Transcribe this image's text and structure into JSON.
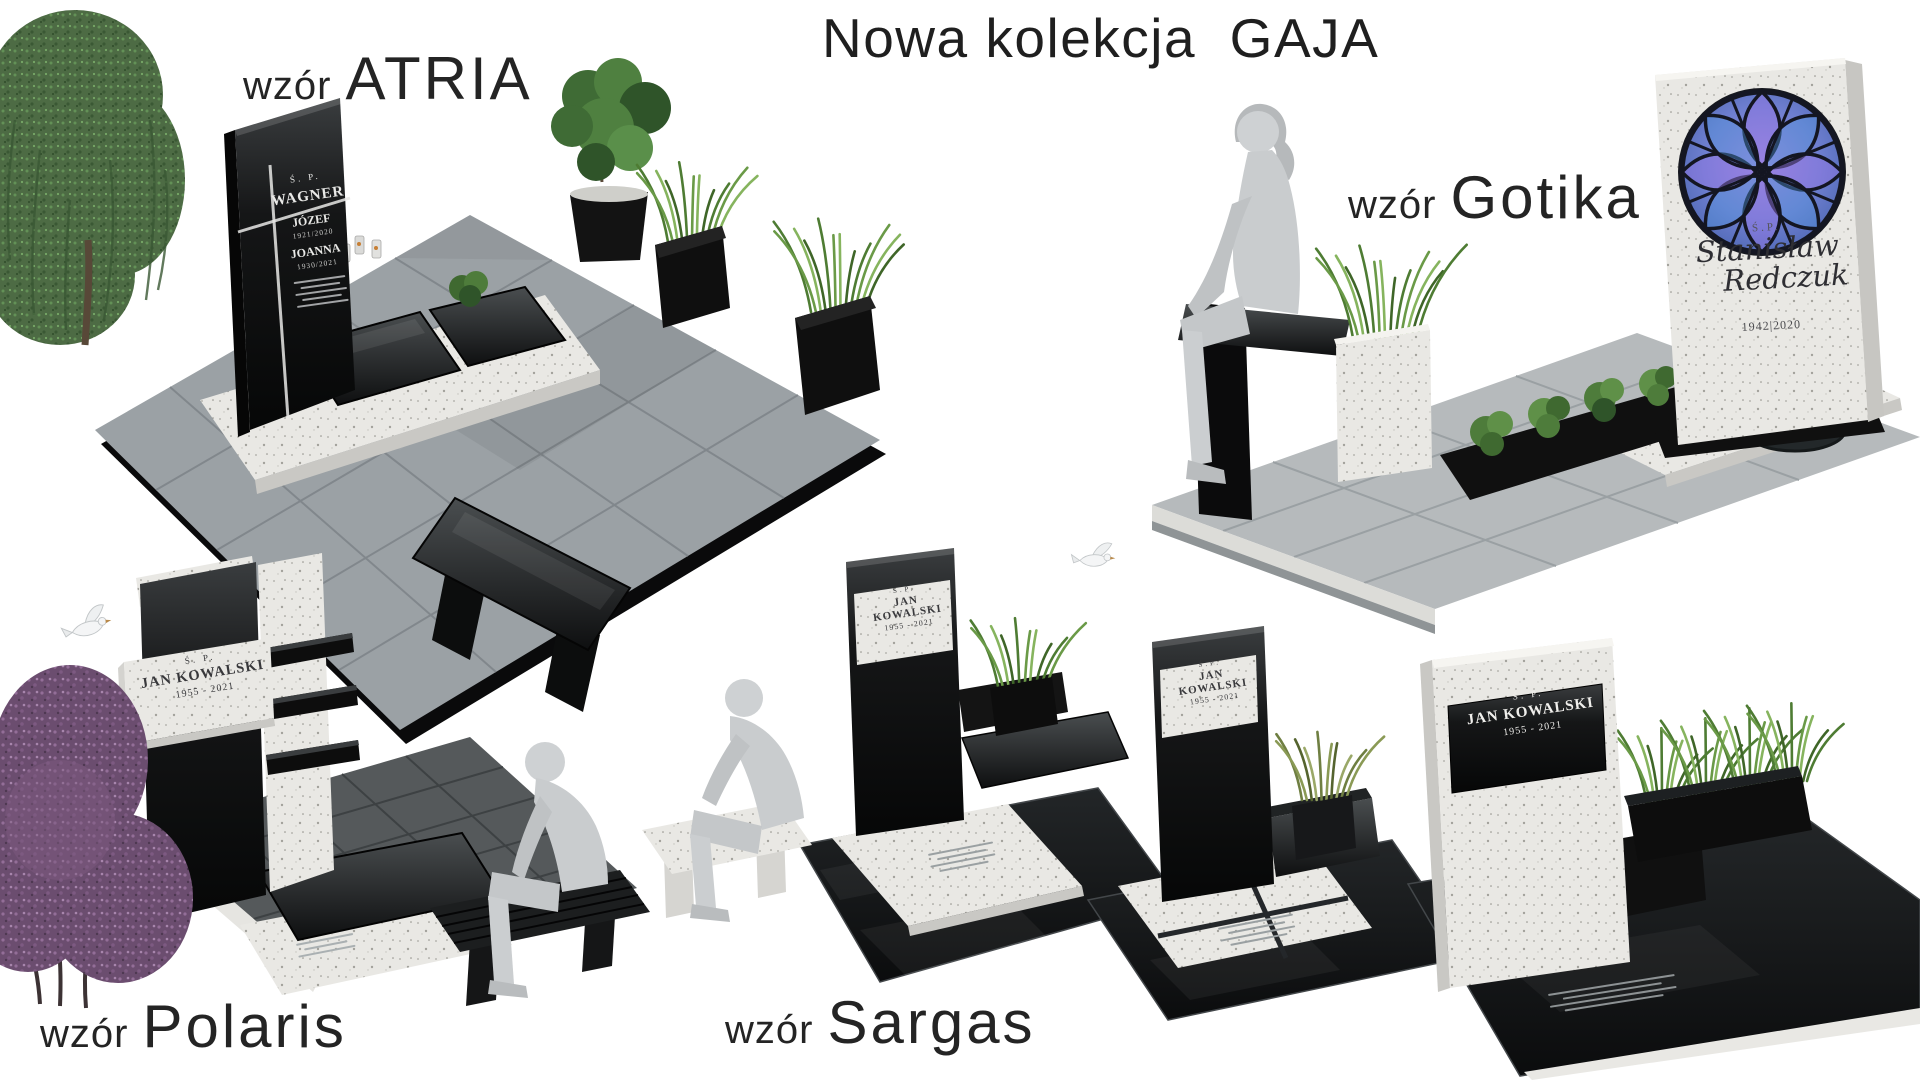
{
  "poster": {
    "title": "Nowa kolekcja  GAJA"
  },
  "labels": {
    "atria": {
      "prefix": "wzór",
      "name": "ATRIA"
    },
    "gotika": {
      "prefix": "wzór",
      "name": "Gotika"
    },
    "polaris": {
      "prefix": "wzór",
      "name": "Polaris"
    },
    "sargas": {
      "prefix": "wzór",
      "name": "Sargas"
    }
  },
  "inscriptions": {
    "atria": {
      "sp": "Ś. P.",
      "surname": "WAGNER",
      "name1": "JÓZEF",
      "dates1": "1921/2020",
      "name2": "JOANNA",
      "dates2": "1930/2021"
    },
    "gotika": {
      "sp": "Ś.P.",
      "name_line1": "Stanisław",
      "name_line2": "Redczuk",
      "dates": "1942|2020"
    },
    "polaris": {
      "sp": "Ś. P.",
      "name": "JAN KOWALSKI",
      "dates": "1955 - 2021"
    },
    "sargas_front": {
      "sp": "Ś.P.",
      "name": "JAN KOWALSKI",
      "dates": "1955 - 2021"
    },
    "sargas_side": {
      "sp": "Ś.P.",
      "name": "JAN KOWALSKI",
      "dates": "1955 - 2021"
    },
    "sargas_white": {
      "sp": "Ś. P.",
      "name": "JAN KOWALSKI",
      "dates": "1955 - 2021"
    }
  },
  "colors": {
    "granite_black": "#121314",
    "terrazzo_white": "#e9e8e4",
    "tile_gray": "#9ba1a5",
    "dark_tile": "#55595b",
    "foliage_green": "#4e7c33",
    "lilac_purple": "#6b4d6f",
    "rosette_purple": "#8d7ad8",
    "rosette_blue": "#4f79c8",
    "statue_gray": "#c9ccce",
    "background": "#ffffff"
  }
}
